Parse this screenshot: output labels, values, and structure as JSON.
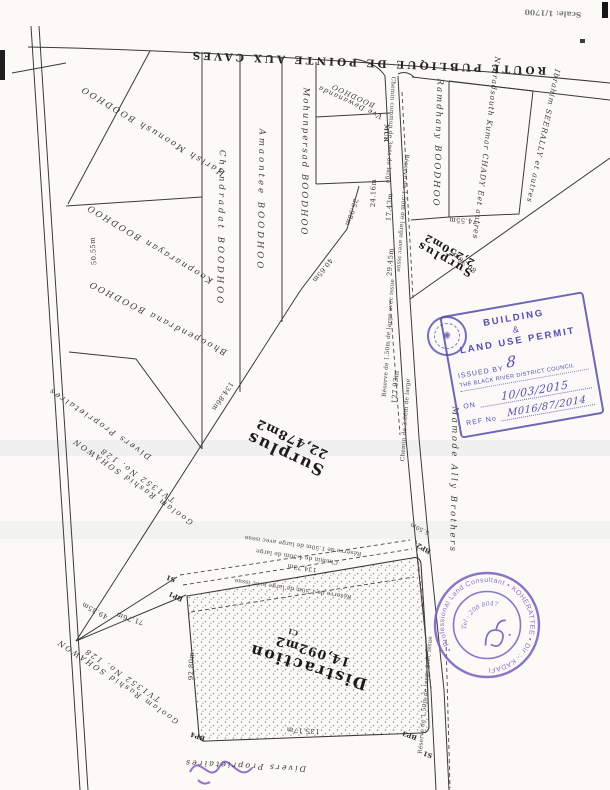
{
  "page": {
    "scale_note": "Scale: 1/1700",
    "road_label": "ROUTE PUBLIQUE DE POINTE AUX CAVES"
  },
  "owners": {
    "harish": "Harish Moonush BOODHOO",
    "koopnarayan": "Koopnarayan BOODHOO",
    "bhoopendrana": "Bhoopendrana BOODHOO",
    "divers": "Divers Proprietaires",
    "goolam_line1": "Goolam Rashid SOHAWON",
    "goolam_line2": "TV1352 No. 128",
    "chandradat": "Chandradat BOODHOO",
    "amaontee": "Amaontee BOODHOO",
    "mohunpersad": "Mohunpersad BOODHOO",
    "vve_line1": "Vve Dewananda",
    "vve_line2": "BOODHOO",
    "ramdhany": "Ramdhany BOODHOO",
    "chady": "Neeradsouth Kumar CHADY Eet autres",
    "seerally": "Ibrahim SEERALLY et autres",
    "mamode": "Mamode Ally Brothers"
  },
  "areas": {
    "surplus_main": {
      "name": "Surplus",
      "area": "22,478m2"
    },
    "surplus_small": {
      "name": "Surplus",
      "area": "2,250m2"
    },
    "distraction": {
      "name": "Distraction",
      "area": "14,092m2",
      "code": "C1"
    }
  },
  "measurements": {
    "m50_55": "50.55m",
    "m134_86": "134.86m",
    "m40_65": "40.65m",
    "m25_98": "25.98m",
    "m24_16": "24.16m",
    "m17_43": "17.43m",
    "m74_55": "74.55m",
    "m80_36": "80.36m",
    "m127_93": "127.93m",
    "m29_45": "29.45m",
    "m6_50": "6.50m",
    "m92_80": "92.80m",
    "m135_17": "135.17m",
    "m134_73": "134.73m",
    "m49_35": "49.35m",
    "m71_76": "71.76m"
  },
  "paths": {
    "chemin_commun": "Chemin commun de 3mts de large",
    "chemin_366": "Chemin de 3.66m de large",
    "chemin_450": "Chemin de 4.50m de large",
    "reserve": "Réserve de 1.50m de large avec issue",
    "mur": "MUR"
  },
  "points": {
    "bp1": "BP1",
    "bp2": "BP2",
    "bp3": "BP3",
    "bp4": "BP4",
    "s1": "S1"
  },
  "permit_stamp": {
    "line1": "BUILDING",
    "line2": "&",
    "line3": "LAND USE PERMIT",
    "issued_by": "ISSUED BY",
    "issued_mark": "8",
    "authority": "THE BLACK RIVER DISTRICT COUNCIL",
    "on_label": "ON",
    "date": "10/03/2015",
    "ref_label": "REF No",
    "ref_value": "M016/87/2014",
    "color": "#584aac"
  },
  "seal": {
    "ring_text": "• Professional Land Consultant • KOHERATTEE • Dir :- KADAFI",
    "phone": "Tel : 208 8047",
    "color": "#7a5cc0"
  }
}
